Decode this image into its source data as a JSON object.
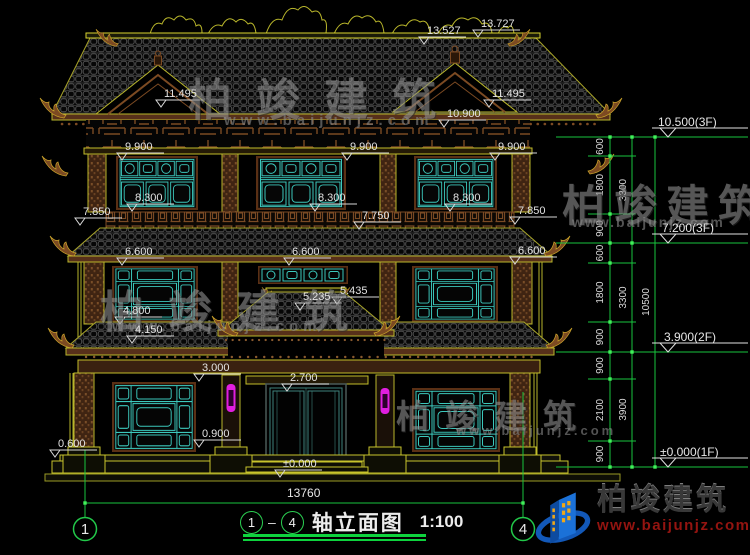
{
  "marks": {
    "m13_527": "13.527",
    "m13_727": "13.727",
    "m11_495_l": "11.495",
    "m11_495_r": "11.495",
    "m10_900": "10.900",
    "m9_900_l": "9.900",
    "m9_900_m": "9.900",
    "m9_900_r": "9.900",
    "m8_300_l": "8.300",
    "m8_300_m": "8.300",
    "m8_300_r": "8.300",
    "m7_850_l": "7.850",
    "m7_750": "7.750",
    "m7_850_r": "7.850",
    "m6_600_l": "6.600",
    "m6_600_m": "6.600",
    "m6_600_r": "6.600",
    "m5_435": "5.435",
    "m5_235": "5.235",
    "m4_800": "4.800",
    "m4_150": "4.150",
    "m3_000": "3.000",
    "m2_700": "2.700",
    "m0_900": "0.900",
    "m0_600": "0.600",
    "m0_000": "±0.000"
  },
  "levels": {
    "l1": "10.500(3F)",
    "l2": "7.200(3F)",
    "l3": "3.900(2F)",
    "l4": "±0.000(1F)"
  },
  "vdims": {
    "c1": [
      "600",
      "1800",
      "900",
      "600",
      "1800",
      "900",
      "900",
      "2100",
      "900"
    ],
    "c2": [
      "3300",
      "3300",
      "3900"
    ],
    "c3": [
      "10500"
    ]
  },
  "hdims": {
    "total": "13760"
  },
  "axes": {
    "left": "1",
    "right": "4"
  },
  "titlebar": {
    "from": "1",
    "sep": "–",
    "to": "4",
    "name": "轴立面图",
    "scale": "1:100"
  },
  "watermark": {
    "cn": "柏竣建筑",
    "url": "www.baijunjz.com"
  },
  "logo": {
    "cn": "柏竣建筑",
    "url": "www.baijunjz.com"
  },
  "colors": {
    "background": "#000000",
    "outline_yellow": "#b9b62b",
    "ridge_yellow": "#d8d32f",
    "wood_brown": "#7a4a22",
    "lattice_cyan": "#3cc8bc",
    "dim_green": "#18c43e",
    "grip_green": "#41f05a",
    "dim_text_white": "#e2e2e2",
    "lamp_magenta": "#e01ee0",
    "logo_blue": "#1b71d8",
    "logo_url_red": "#941410"
  }
}
